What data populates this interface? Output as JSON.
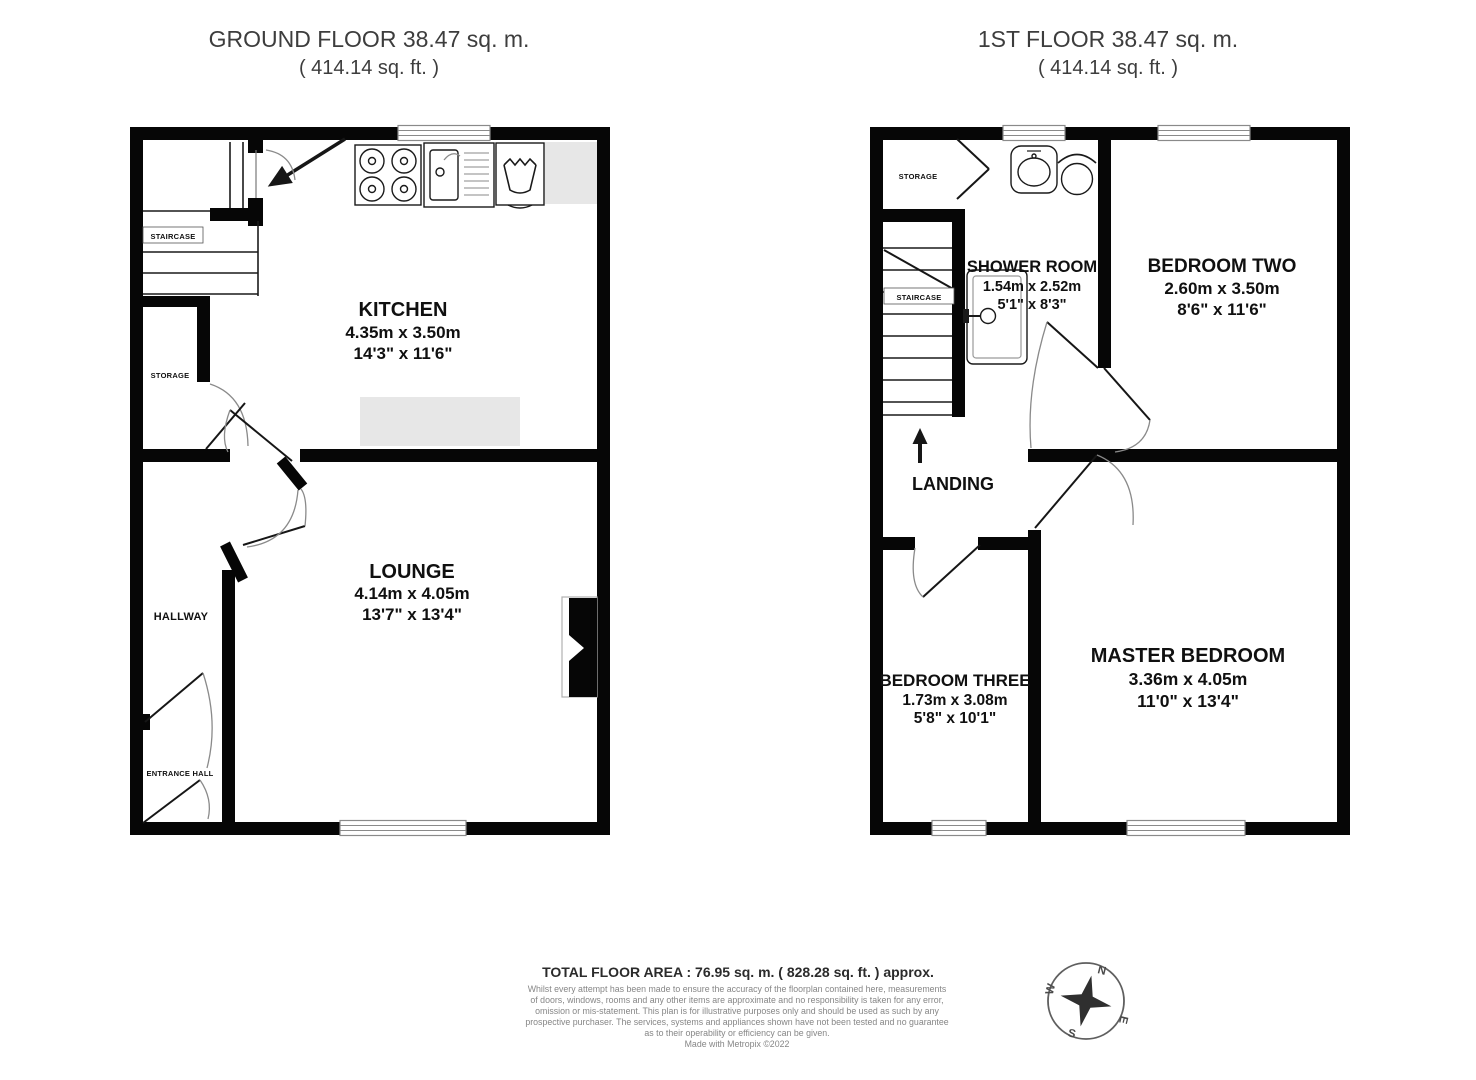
{
  "ground_floor": {
    "title": "GROUND FLOOR 38.47 sq. m.",
    "subtitle": "( 414.14 sq. ft. )",
    "rooms": {
      "kitchen": {
        "name": "KITCHEN",
        "metric": "4.35m x 3.50m",
        "imperial": "14'3\" x 11'6\""
      },
      "lounge": {
        "name": "LOUNGE",
        "metric": "4.14m x 4.05m",
        "imperial": "13'7\" x 13'4\""
      }
    },
    "labels": {
      "staircase": "STAIRCASE",
      "storage": "STORAGE",
      "hallway": "HALLWAY",
      "entrance_hall": "ENTRANCE HALL"
    }
  },
  "first_floor": {
    "title": "1ST FLOOR 38.47 sq. m.",
    "subtitle": "( 414.14 sq. ft. )",
    "rooms": {
      "shower_room": {
        "name": "SHOWER ROOM",
        "metric": "1.54m x 2.52m",
        "imperial": "5'1\" x 8'3\""
      },
      "bedroom_two": {
        "name": "BEDROOM TWO",
        "metric": "2.60m x 3.50m",
        "imperial": "8'6\" x 11'6\""
      },
      "bedroom_three": {
        "name": "BEDROOM THREE",
        "metric": "1.73m x 3.08m",
        "imperial": "5'8\" x 10'1\""
      },
      "master_bedroom": {
        "name": "MASTER BEDROOM",
        "metric": "3.36m x 4.05m",
        "imperial": "11'0\" x 13'4\""
      }
    },
    "labels": {
      "staircase": "STAIRCASE",
      "storage": "STORAGE",
      "landing": "LANDING"
    }
  },
  "footer": {
    "total_area": "TOTAL FLOOR AREA : 76.95 sq. m. ( 828.28 sq. ft. ) approx.",
    "disclaimer": [
      "Whilst every attempt has been made to ensure the accuracy of the floorplan contained here, measurements",
      "of doors, windows, rooms and any other items are approximate and no responsibility is taken for any error,",
      "omission or mis-statement. This plan is for illustrative purposes only and should be used as such by any",
      "prospective purchaser. The services, systems and appliances shown have not been tested and no guarantee",
      "as to their operability or efficiency can be given."
    ],
    "credit": "Made with Metropix ©2022"
  },
  "compass": {
    "north": "N",
    "east": "E",
    "south": "S",
    "west": "W"
  },
  "colors": {
    "wall": "#060606",
    "counter_gray": "#e7e7e7",
    "arc_gray": "#8a8a8a",
    "text": "#101010",
    "muted": "#868686"
  }
}
